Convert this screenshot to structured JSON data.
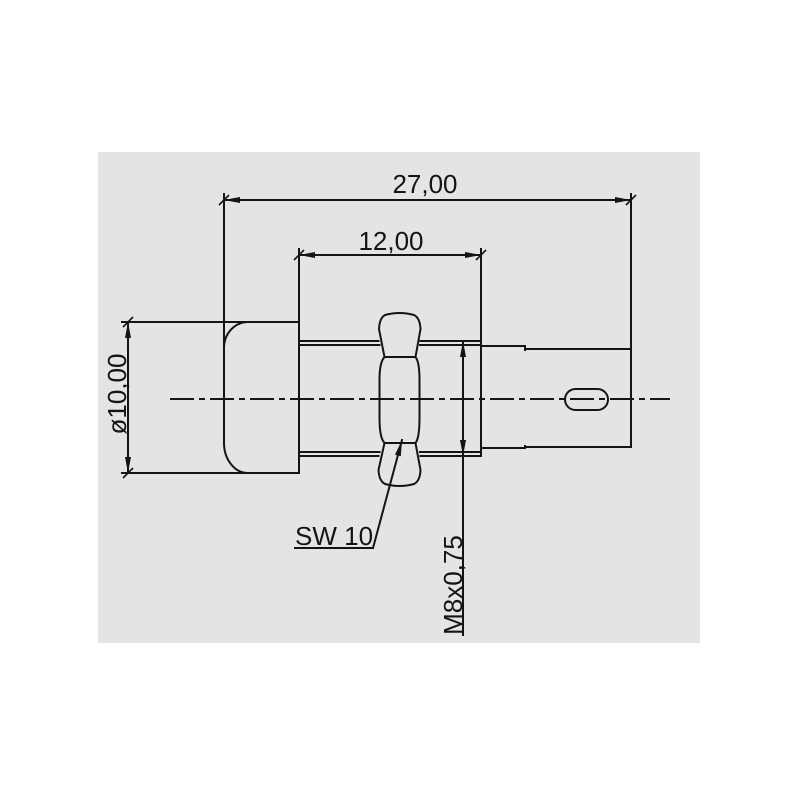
{
  "page": {
    "background_color": "#ffffff"
  },
  "drawing": {
    "kind": "technical-dimension-drawing",
    "subject": "panel-mount socket side view",
    "canvas_color": "#e4e4e4",
    "line_color": "#141414",
    "labels": {
      "overall_length": "27,00",
      "body_length": "12,00",
      "head_diameter": "ø10,00",
      "wrench_size": "SW 10",
      "thread": "M8x0,75"
    }
  }
}
